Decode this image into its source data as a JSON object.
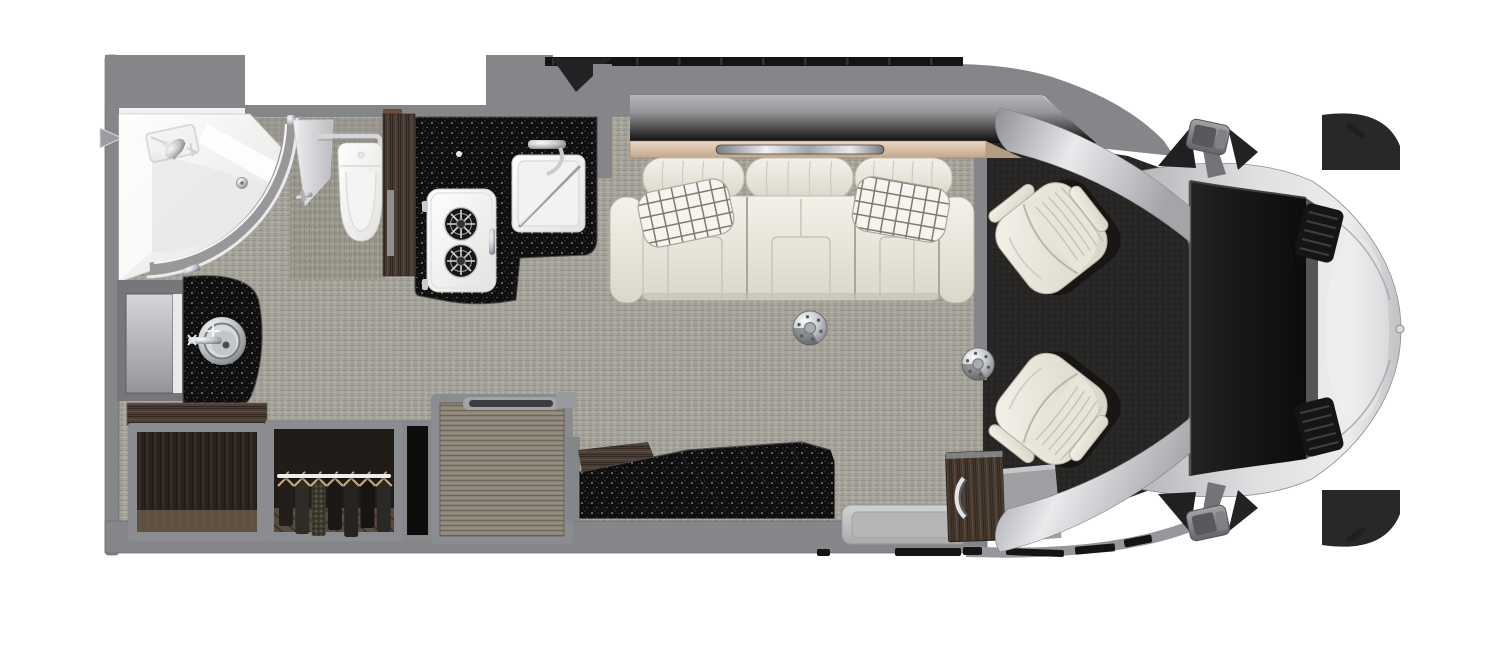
{
  "meta": {
    "title": "Motorhome floor plan - top-down interior view",
    "canvas_width": 1500,
    "canvas_height": 667
  },
  "palette": {
    "bg": "#ffffff",
    "wall": "#85868a",
    "wall_dark": "#6e6f73",
    "wall_edge": "#5f6064",
    "floor": "#a7a49c",
    "floor_dark": "#918e86",
    "floor_light": "#b8b5ad",
    "cab_carpet": "#272624",
    "counter_black": "#0f0f0f",
    "black_trim": "#141414",
    "wood_dark": "#46392f",
    "wood_mid": "#55463a",
    "chest_top": "#8b8276",
    "shelf_wood": "#d9c4ac",
    "ivory": "#efede5",
    "ivory_shadow": "#c8c4b7",
    "seat_cream": "#f0eee6",
    "chrome": "#c9ccd0",
    "body_silver": "#d6d7da",
    "windshield": "#181a19",
    "white_fixture": "#f6f6f4",
    "step_floor": "#c7c8ca",
    "hanger_tan": "#c8a878"
  },
  "regions": {
    "bathroom": {
      "label": "rear bathroom",
      "fixtures": [
        "corner-shower",
        "shower-glass-door",
        "toilet",
        "grab-rail",
        "vanity-counter",
        "vanity-sink",
        "mirror-cabinet"
      ]
    },
    "kitchen": {
      "label": "galley kitchen",
      "fixtures": [
        "galley-counter",
        "two-burner-cooktop",
        "kitchen-sink",
        "kitchen-faucet",
        "wood-side-panel"
      ]
    },
    "storage": {
      "label": "storage run",
      "fixtures": [
        "open-cabinet",
        "wardrobe",
        "hanging-clothes",
        "storage-chest",
        "bench-slab"
      ]
    },
    "living": {
      "label": "living area slide-out",
      "fixtures": [
        "overhead-cabinet",
        "display-shelf",
        "led-light-strip",
        "three-seat-sofa",
        "throw-pillow-left",
        "throw-pillow-right",
        "table-pedestal-rear",
        "table-pedestal-front"
      ]
    },
    "entry": {
      "label": "entry",
      "fixtures": [
        "entry-step-well",
        "entry-cabinet",
        "exterior-steps"
      ]
    },
    "cab": {
      "label": "driver cab",
      "fixtures": [
        "driver-seat",
        "passenger-seat",
        "cab-carpet",
        "windshield",
        "hood",
        "hood-vent-upper",
        "hood-vent-lower",
        "side-mirror-upper",
        "side-mirror-lower",
        "front-bumper",
        "bumper-sensor"
      ]
    }
  },
  "counts": {
    "sofa_sections": 3,
    "pillows": 2,
    "burners": 2,
    "hangers": 7,
    "hood_vents": 2,
    "vent_slats": 5,
    "cab_seats": 2,
    "table_pedestals": 2,
    "slide_seal_ticks": 10
  },
  "wardrobe": {
    "garments": [
      {
        "color": "#211e1b",
        "h": 44,
        "knit": false
      },
      {
        "color": "#2f2c27",
        "h": 52,
        "knit": false
      },
      {
        "color": "#3d3a2e",
        "h": 54,
        "knit": true
      },
      {
        "color": "#1b1917",
        "h": 48,
        "knit": false
      },
      {
        "color": "#262420",
        "h": 55,
        "knit": false
      },
      {
        "color": "#171513",
        "h": 46,
        "knit": false
      },
      {
        "color": "#2b2925",
        "h": 50,
        "knit": false
      }
    ]
  }
}
